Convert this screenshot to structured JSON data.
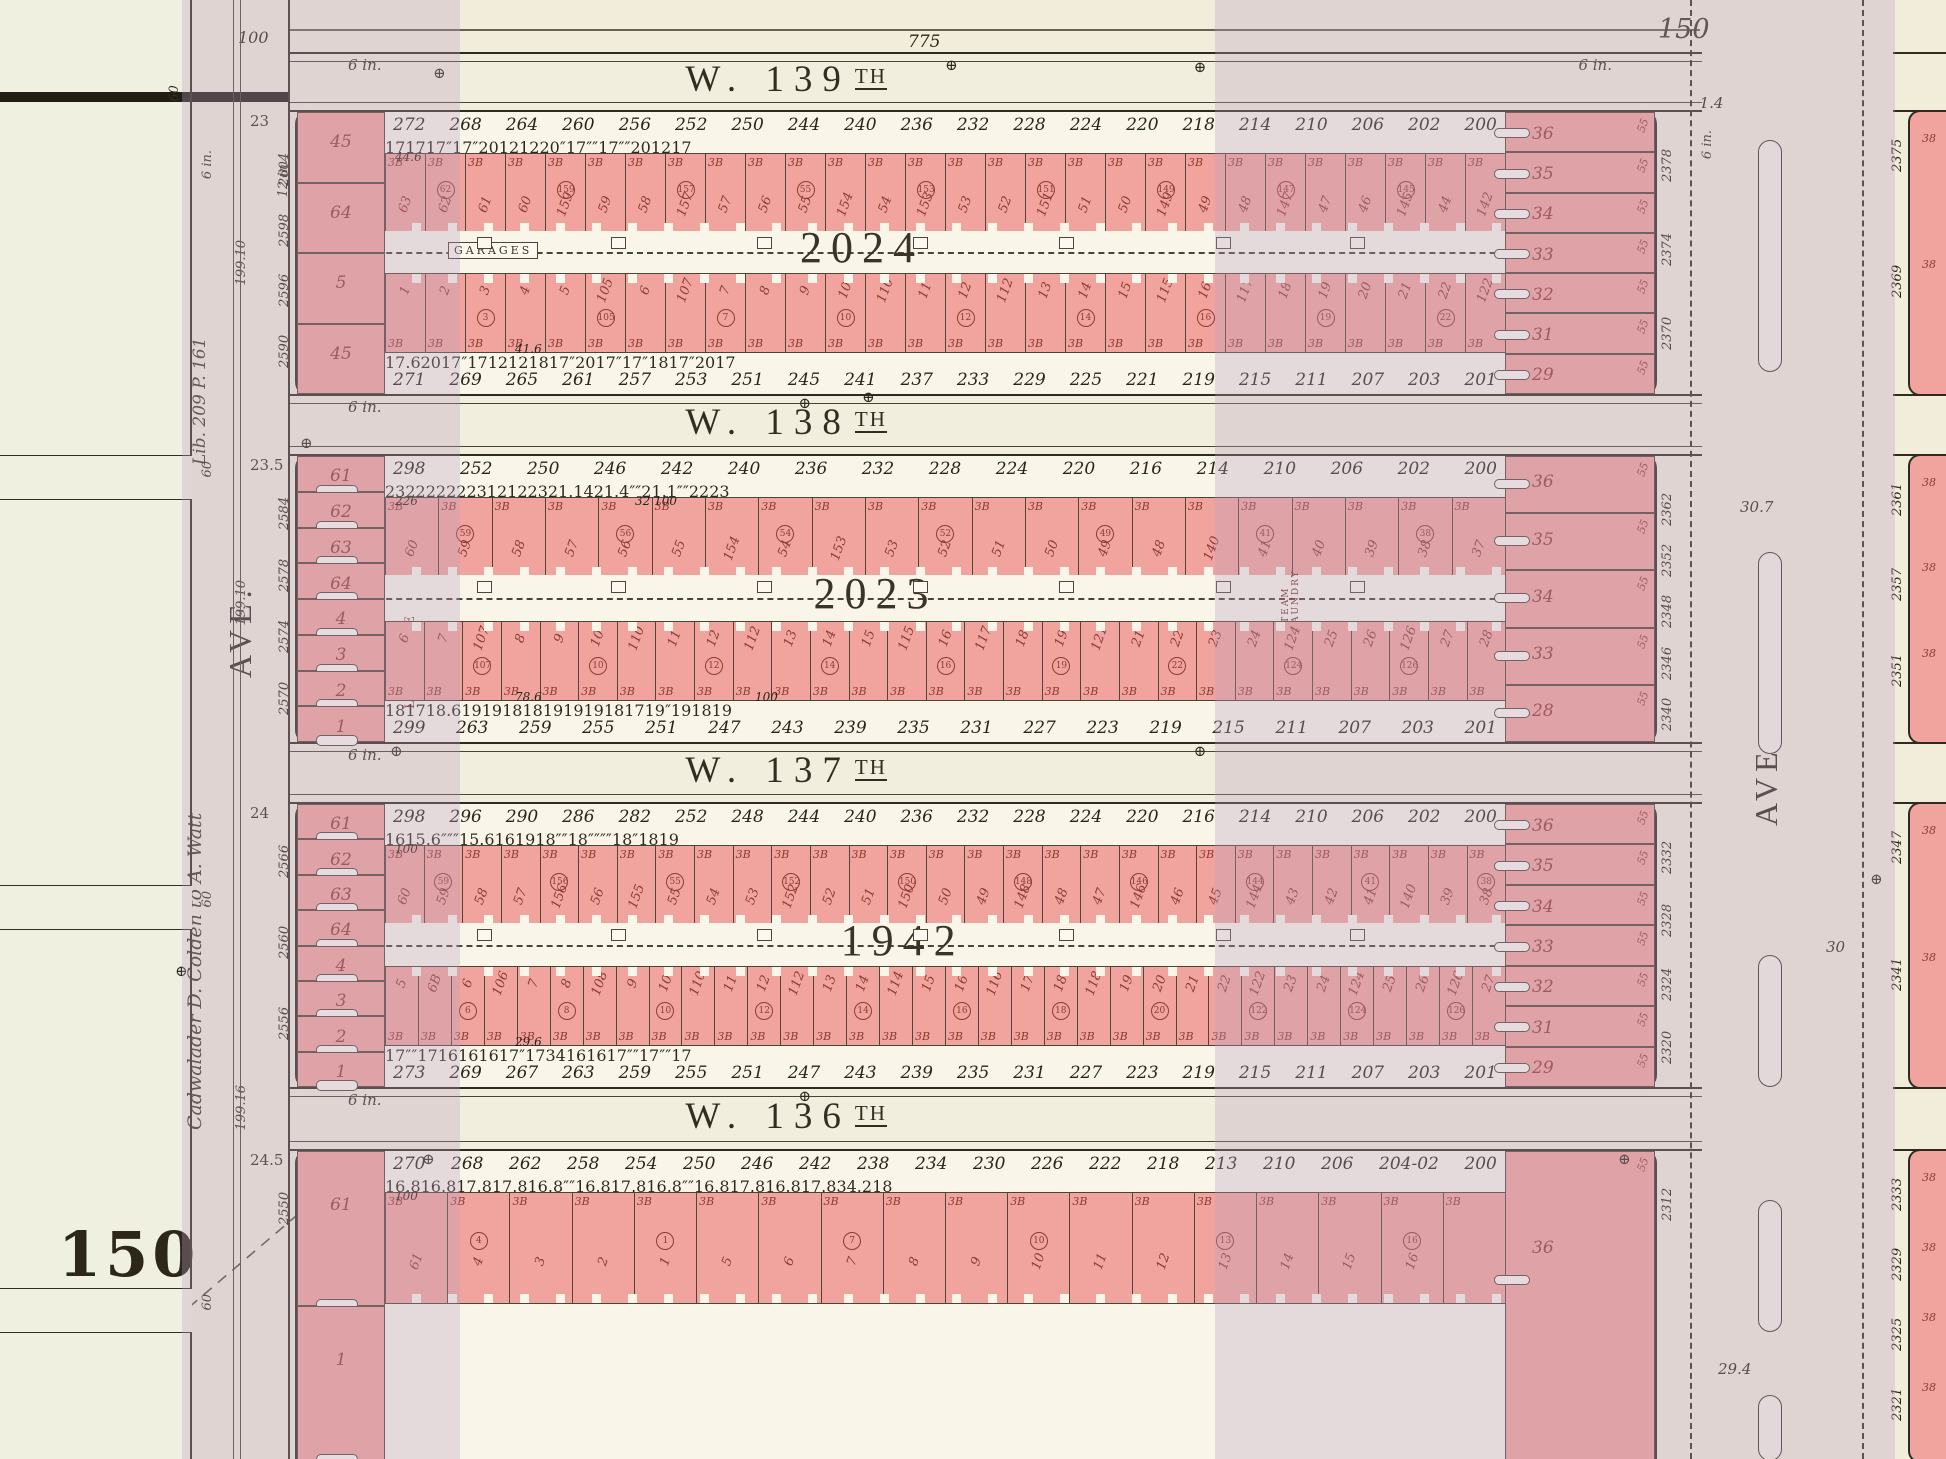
{
  "page": {
    "plate_number_large": "150",
    "plate_number_top": "150",
    "top_frontage_total": "775",
    "avenue_width": "100",
    "top_margin_width": "60"
  },
  "left_margin": {
    "deed_text": "Cadwalader D. Colden to A. Watt",
    "liber_text": "Lib. 209  P. 161",
    "depth_labels": [
      "199.10",
      "199.10",
      "199.16"
    ],
    "street_width_labels": [
      "60",
      "60",
      "60"
    ]
  },
  "avenues": {
    "left": {
      "label": "AVE.",
      "water_main": "12 in.",
      "water_main_west": "6 in."
    },
    "right": {
      "label": "AVE.",
      "water_main": "6 in.",
      "block_distances": [
        "31.4",
        "30.7",
        "30",
        "29.4"
      ]
    }
  },
  "streets": [
    {
      "prefix": "W.",
      "number": "139",
      "suffix": "TH",
      "water_main": "6 in.",
      "water_main_right": "6 in.",
      "corner_depth": "23"
    },
    {
      "prefix": "W.",
      "number": "138",
      "suffix": "TH",
      "water_main": "6 in.",
      "corner_depth": "23.5"
    },
    {
      "prefix": "W.",
      "number": "137",
      "suffix": "TH",
      "water_main": "6 in.",
      "corner_depth": "24"
    },
    {
      "prefix": "W.",
      "number": "136",
      "suffix": "TH",
      "water_main": "6 in.",
      "corner_depth": "24.5"
    }
  ],
  "blocks": [
    {
      "number": "2024",
      "house_numbers_top": [
        "272",
        "268",
        "264",
        "260",
        "256",
        "252",
        "250",
        "244",
        "240",
        "236",
        "232",
        "228",
        "224",
        "220",
        "218",
        "214",
        "210",
        "206",
        "202",
        "200"
      ],
      "house_numbers_bottom": [
        "271",
        "269",
        "265",
        "261",
        "257",
        "253",
        "251",
        "245",
        "241",
        "237",
        "233",
        "229",
        "225",
        "221",
        "219",
        "215",
        "211",
        "207",
        "203",
        "201"
      ],
      "lot_widths_top": [
        "17",
        "17",
        "17",
        "″",
        "17",
        "″",
        "20",
        "12",
        "12",
        "20",
        "″",
        "17",
        "″",
        "″",
        "17",
        "″",
        "″",
        "20",
        "12",
        "17"
      ],
      "lot_widths_bottom": [
        "17.6",
        "20",
        "17",
        "″",
        "17",
        "12",
        "12",
        "18",
        "17",
        "″",
        "20",
        "17",
        "″",
        "17",
        "″",
        "18",
        "17",
        "″",
        "20",
        "17"
      ],
      "lots_north": [
        "63",
        "62",
        "61",
        "60",
        "159",
        "59",
        "58",
        "157",
        "57",
        "56",
        "55",
        "154",
        "54",
        "153",
        "53",
        "52",
        "151",
        "51",
        "50",
        "149",
        "49",
        "48",
        "147",
        "47",
        "46",
        "145",
        "44",
        "142"
      ],
      "lots_south": [
        "1",
        "2",
        "3",
        "4",
        "5",
        "105",
        "6",
        "107",
        "7",
        "8",
        "9",
        "10",
        "110",
        "11",
        "12",
        "112",
        "13",
        "14",
        "15",
        "115",
        "16",
        "117",
        "18",
        "19",
        "20",
        "21",
        "22",
        "122"
      ],
      "corner_lots_west": [
        "45",
        "64",
        "5",
        "45"
      ],
      "corner_lots_east": [
        "36",
        "35",
        "34",
        "33",
        "32",
        "31",
        "29"
      ],
      "frontage_west": [
        "2604",
        "2598",
        "2596",
        "2590"
      ],
      "frontage_east": [
        "2378",
        "2374",
        "2370"
      ],
      "unit_label": "3B",
      "depth_label": "55",
      "interior_label": "GARAGES",
      "dims": [
        "44.6",
        "41.6"
      ]
    },
    {
      "number": "2023",
      "house_numbers_top": [
        "298",
        "252",
        "250",
        "246",
        "242",
        "240",
        "236",
        "232",
        "228",
        "224",
        "220",
        "216",
        "214",
        "210",
        "206",
        "202",
        "200"
      ],
      "house_numbers_bottom": [
        "299",
        "263",
        "259",
        "255",
        "251",
        "247",
        "243",
        "239",
        "235",
        "231",
        "227",
        "223",
        "219",
        "215",
        "211",
        "207",
        "203",
        "201"
      ],
      "lot_widths_top": [
        "23",
        "22",
        "22",
        "22",
        "23",
        "12",
        "12",
        "23",
        "21.14",
        "21.4",
        "″",
        "″",
        "21.1",
        "″",
        "″",
        "22",
        "23"
      ],
      "lot_widths_bottom": [
        "18",
        "17",
        "18.6",
        "19",
        "19",
        "18",
        "18",
        "19",
        "19",
        "19",
        "18",
        "17",
        "19",
        "″",
        "19",
        "18",
        "19"
      ],
      "lots_north": [
        "60",
        "59",
        "58",
        "57",
        "56",
        "55",
        "154",
        "54",
        "153",
        "53",
        "52",
        "51",
        "50",
        "49",
        "48",
        "140",
        "41",
        "40",
        "39",
        "38",
        "37"
      ],
      "lots_south": [
        "6",
        "7",
        "107",
        "8",
        "9",
        "10",
        "110",
        "11",
        "12",
        "112",
        "13",
        "14",
        "15",
        "115",
        "16",
        "117",
        "18",
        "19",
        "121",
        "21",
        "22",
        "23",
        "24",
        "124",
        "25",
        "26",
        "126",
        "27",
        "28"
      ],
      "corner_lots_west": [
        "61",
        "62",
        "63",
        "64",
        "4",
        "3",
        "2",
        "1"
      ],
      "corner_lots_east": [
        "36",
        "35",
        "34",
        "33",
        "28"
      ],
      "frontage_west": [
        "2584",
        "2578",
        "2574",
        "2570"
      ],
      "frontage_east": [
        "2362",
        "2352",
        "2348",
        "2346",
        "2340"
      ],
      "unit_label": "3B",
      "depth_label": "55",
      "interior_label": "LA VENICE",
      "interior_label_2": "STEAM LAUNDRY",
      "dims": [
        "226",
        "78.6",
        "32 100",
        "100"
      ]
    },
    {
      "number": "1942",
      "house_numbers_top": [
        "298",
        "296",
        "290",
        "286",
        "282",
        "252",
        "248",
        "244",
        "240",
        "236",
        "232",
        "228",
        "224",
        "220",
        "216",
        "214",
        "210",
        "206",
        "202",
        "200"
      ],
      "house_numbers_bottom": [
        "273",
        "269",
        "267",
        "263",
        "259",
        "255",
        "251",
        "247",
        "243",
        "239",
        "235",
        "231",
        "227",
        "223",
        "219",
        "215",
        "211",
        "207",
        "203",
        "201"
      ],
      "lot_widths_top": [
        "16",
        "15.6",
        "″",
        "″",
        "″",
        "15.6",
        "16",
        "19",
        "18",
        "″",
        "″",
        "18",
        "″",
        "″",
        "″",
        "″",
        "18",
        "″",
        "18",
        "19"
      ],
      "lot_widths_bottom": [
        "17",
        "″",
        "″",
        "17",
        "16",
        "16",
        "16",
        "17",
        "″",
        "17",
        "34",
        "16",
        "16",
        "17",
        "″",
        "″",
        "17",
        "″",
        "″",
        "17"
      ],
      "lots_north": [
        "60",
        "59",
        "58",
        "57",
        "156",
        "56",
        "155",
        "55",
        "54",
        "53",
        "152",
        "52",
        "51",
        "150",
        "50",
        "49",
        "148",
        "48",
        "47",
        "146",
        "46",
        "45",
        "144",
        "43",
        "42",
        "41",
        "140",
        "39",
        "38"
      ],
      "lots_south": [
        "5",
        "6B",
        "6",
        "106",
        "7",
        "8",
        "108",
        "9",
        "10",
        "110",
        "11",
        "12",
        "112",
        "13",
        "14",
        "114",
        "15",
        "16",
        "116",
        "17",
        "18",
        "118",
        "19",
        "20",
        "21",
        "22",
        "122",
        "23",
        "24",
        "124",
        "25",
        "26",
        "126",
        "27"
      ],
      "corner_lots_west": [
        "61",
        "62",
        "63",
        "64",
        "4",
        "3",
        "2",
        "1"
      ],
      "corner_lots_east": [
        "36",
        "35",
        "34",
        "33",
        "32",
        "31",
        "29"
      ],
      "frontage_west": [
        "2566",
        "2560",
        "2556"
      ],
      "frontage_east": [
        "2332",
        "2328",
        "2324",
        "2320"
      ],
      "unit_label": "3B",
      "depth_label": "55",
      "interior_label": "A.M.E. CHURCH",
      "dims": [
        "100",
        "29.6"
      ]
    },
    {
      "number": "",
      "house_numbers_top": [
        "270",
        "268",
        "262",
        "258",
        "254",
        "250",
        "246",
        "242",
        "238",
        "234",
        "230",
        "226",
        "222",
        "218",
        "213",
        "210",
        "206",
        "204-02",
        "200"
      ],
      "house_numbers_bottom": [],
      "lot_widths_top": [
        "16.8",
        "16.8",
        "17.8",
        "17.8",
        "16.8",
        "″",
        "″",
        "16.8",
        "17.8",
        "16.8",
        "″",
        "″",
        "16.8",
        "17.8",
        "16.8",
        "17.8",
        "34.2",
        "18"
      ],
      "lot_widths_bottom": [],
      "lots_north": [
        "61",
        "4",
        "3",
        "2",
        "1",
        "5",
        "6",
        "7",
        "8",
        "9",
        "10",
        "11",
        "12",
        "13",
        "14",
        "15",
        "16"
      ],
      "lots_south": [],
      "corner_lots_west": [
        "61",
        "1"
      ],
      "corner_lots_east": [
        "36"
      ],
      "frontage_west": [
        "2550"
      ],
      "frontage_east": [
        "2312"
      ],
      "unit_label": "3B",
      "depth_label": "55",
      "interior_label": "",
      "dims": [
        "100"
      ]
    }
  ],
  "east_blocks": {
    "segments": [
      [
        "2375",
        "2369"
      ],
      [
        "2361",
        "2357",
        "2351"
      ],
      [
        "2347",
        "2341"
      ],
      [
        "2333",
        "2329",
        "2325",
        "2321"
      ]
    ],
    "lot_label": "38",
    "depth_label": "55"
  },
  "symbols": {
    "monument": "⊕"
  }
}
